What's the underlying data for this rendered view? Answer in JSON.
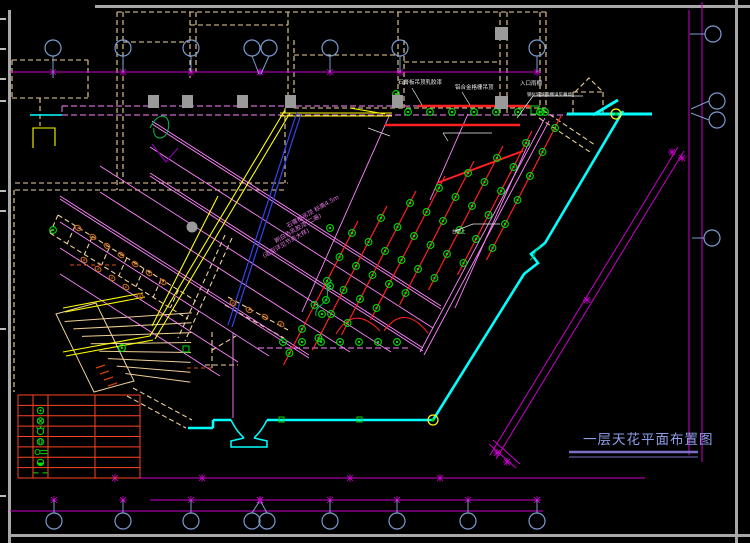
{
  "drawing": {
    "title": {
      "text": "一层天花平面布置图"
    },
    "notes": {
      "note_top_1": "石膏板吊顶乳胶漆",
      "note_top_2": "铝合金格栅吊顶",
      "note_right_1": "入口雨棚",
      "note_right_2": "钢化玻璃雨棚详见幕墙",
      "note_mid": "台阶上",
      "hall_line1": "石膏板吊顶 标高4.5m",
      "hall_line2": "刷白色乳胶漆(二遍)",
      "hall_line3": "(造型详见节点大样)"
    },
    "legend": {
      "symbols": [
        "downlight",
        "spotlight",
        "pendant-lamp",
        "grille-light",
        "wall-lamp",
        "dome-light",
        "light-strip"
      ]
    },
    "grid_bubbles": {
      "top_x": [
        53,
        123,
        191,
        252,
        269,
        330,
        400,
        537
      ],
      "bottom_x": [
        54,
        123,
        191,
        252,
        267,
        330,
        397,
        468,
        537
      ],
      "right": [
        [
          713,
          34,
          690,
          34
        ],
        [
          717,
          101,
          691,
          109
        ],
        [
          717,
          120,
          691,
          113
        ],
        [
          712,
          238,
          692,
          238
        ]
      ]
    },
    "lighting": {
      "circuits": 8,
      "lights_per_circuit": 6,
      "origin": [
        555,
        128
      ],
      "step_along": [
        -12.5,
        24
      ],
      "step_between": [
        -29,
        15
      ],
      "top_row": {
        "y": 112,
        "x0": 408,
        "dx": 22,
        "n": 7
      },
      "bottom_row": {
        "y": 342,
        "x0": 283,
        "dx": 19,
        "n": 7
      }
    },
    "colors": {
      "background": "#000000",
      "wall": "#EFD098",
      "grid_line": "#CC00CC",
      "ceiling_line": "#FF85FF",
      "circuit": "#FF2020",
      "light": "#00DE00",
      "glass_wall": "#00FFFF",
      "corridor": "#FFFF00",
      "axis_blue": "#3344EE",
      "bubble": "#7B9CD0",
      "legend_grid": "#FF4422",
      "title_text": "#8D9FE8",
      "title_rule": "#7A6FC4",
      "fixture": "#C06818",
      "column": "#9A9A9A",
      "frame": "#A8A8A8",
      "note_text": "#EDEDED"
    }
  }
}
